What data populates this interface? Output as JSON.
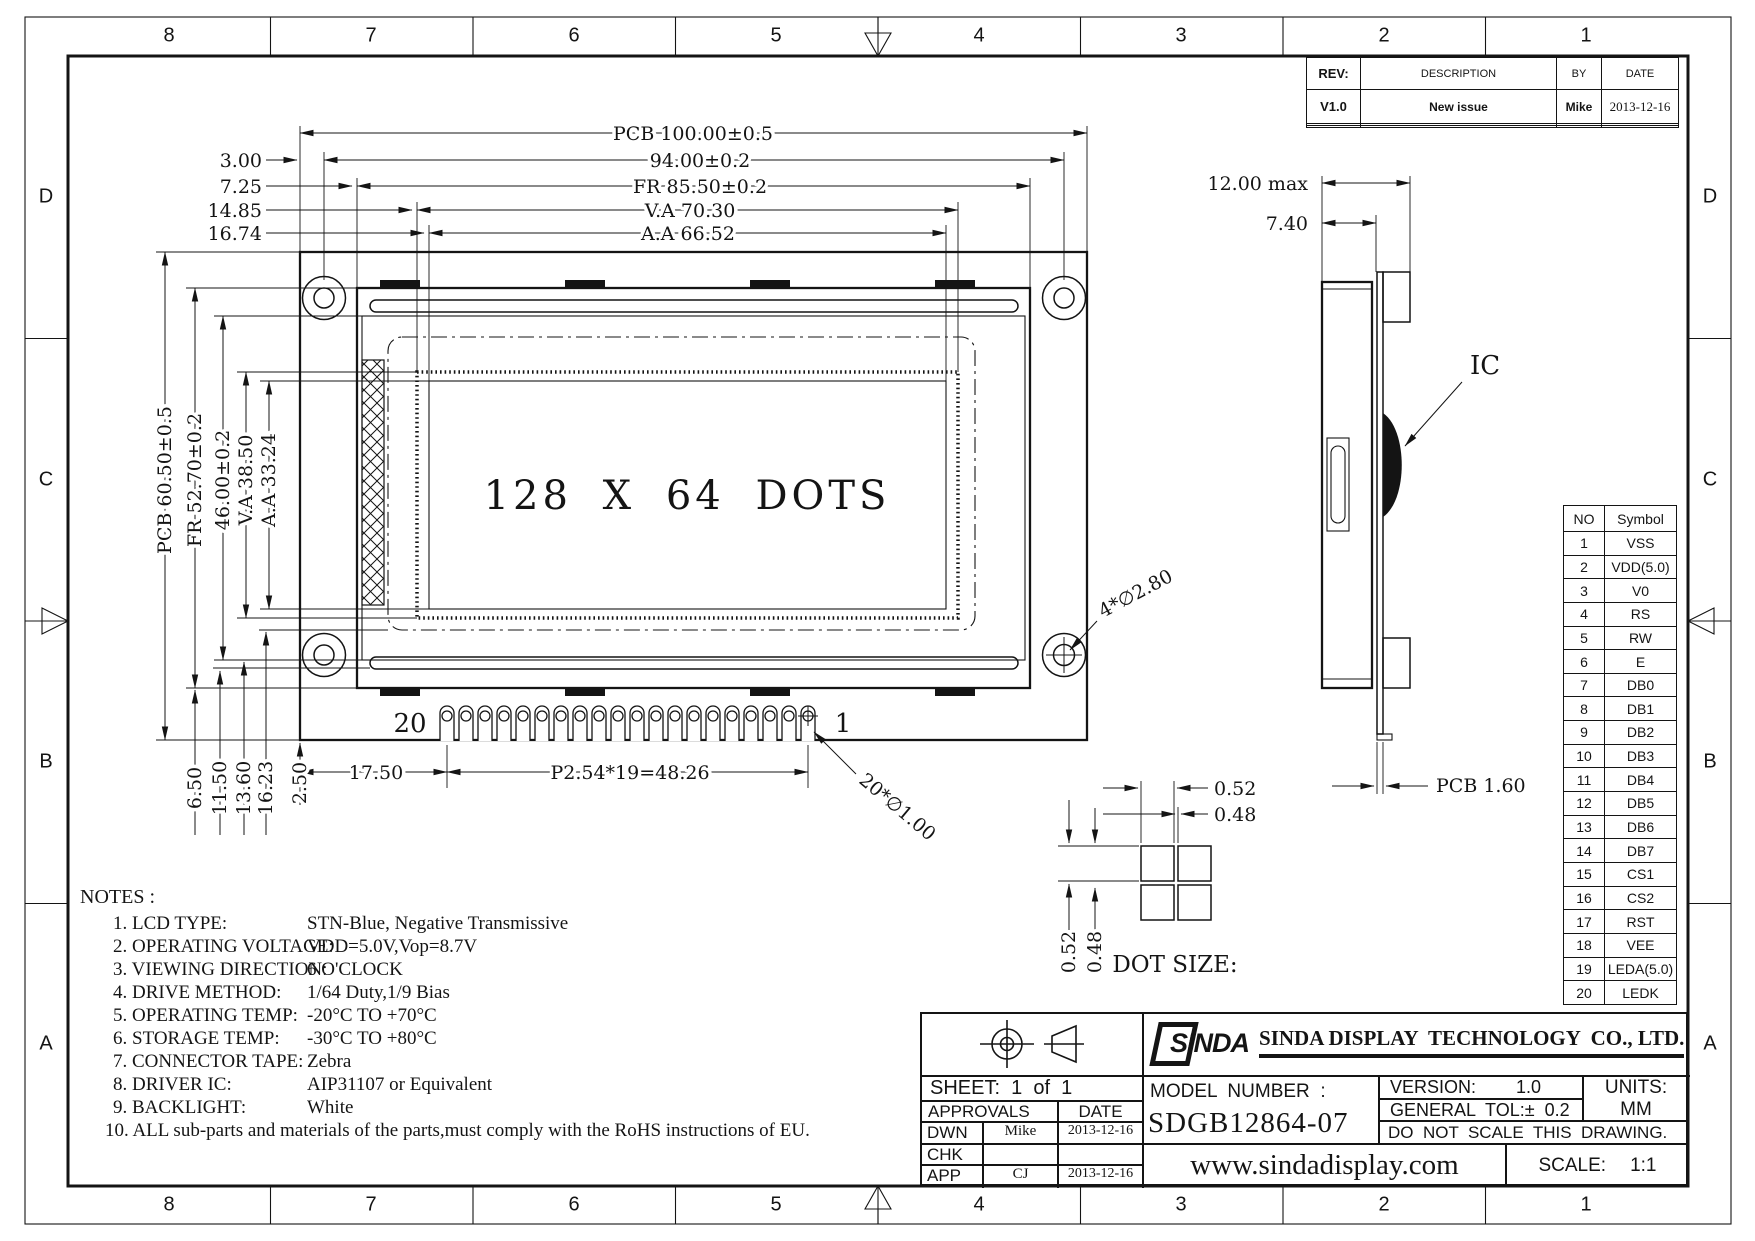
{
  "frame": {
    "cols": [
      "8",
      "7",
      "6",
      "5",
      "4",
      "3",
      "2",
      "1"
    ],
    "rows": [
      "D",
      "C",
      "B",
      "A"
    ]
  },
  "revision_table": {
    "headers": [
      "REV:",
      "DESCRIPTION",
      "BY",
      "DATE"
    ],
    "rows": [
      [
        "V1.0",
        "New issue",
        "Mike",
        "2013-12-16"
      ],
      [
        "",
        "",
        "",
        ""
      ],
      [
        "",
        "",
        "",
        ""
      ]
    ]
  },
  "front_view": {
    "display_text": "128 X 64 DOTS",
    "top_dims": [
      {
        "left": "",
        "label": "PCB 100.00±0.5"
      },
      {
        "left": "3.00",
        "label": "94.00±0.2"
      },
      {
        "left": "7.25",
        "label": "FR 85.50±0.2"
      },
      {
        "left": "14.85",
        "label": "V.A 70.30"
      },
      {
        "left": "16.74",
        "label": "A.A 66.52"
      }
    ],
    "left_dims": [
      "PCB 60.50±0.5",
      "FR 52.70±0.2",
      "46.00±0.2",
      "V.A 38.50",
      "A.A 33.24"
    ],
    "bottom_left_dims": [
      "6.50",
      "11.50",
      "13.60",
      "16.23",
      "2.50"
    ],
    "dim_17_50": "17.50",
    "dim_pitch": "P2.54*19=48.26",
    "pin_last": "20",
    "pin_first": "1",
    "label_pin_hole": "20*∅1.00",
    "label_mount_hole": "4*∅2.80"
  },
  "side_view": {
    "dim_max": "12.00 max",
    "dim_740": "7.40",
    "ic": "IC",
    "pcb": "PCB 1.60"
  },
  "dot_detail": {
    "title": "DOT SIZE:",
    "dim_h": [
      "0.52",
      "0.48"
    ],
    "dim_v": [
      "0.52",
      "0.48"
    ]
  },
  "pin_table": {
    "headers": [
      "NO",
      "Symbol"
    ],
    "rows": [
      [
        "1",
        "VSS"
      ],
      [
        "2",
        "VDD(5.0)"
      ],
      [
        "3",
        "V0"
      ],
      [
        "4",
        "RS"
      ],
      [
        "5",
        "RW"
      ],
      [
        "6",
        "E"
      ],
      [
        "7",
        "DB0"
      ],
      [
        "8",
        "DB1"
      ],
      [
        "9",
        "DB2"
      ],
      [
        "10",
        "DB3"
      ],
      [
        "11",
        "DB4"
      ],
      [
        "12",
        "DB5"
      ],
      [
        "13",
        "DB6"
      ],
      [
        "14",
        "DB7"
      ],
      [
        "15",
        "CS1"
      ],
      [
        "16",
        "CS2"
      ],
      [
        "17",
        "RST"
      ],
      [
        "18",
        "VEE"
      ],
      [
        "19",
        "LEDA(5.0)"
      ],
      [
        "20",
        "LEDK"
      ]
    ]
  },
  "notes": {
    "title": "NOTES :",
    "items": [
      {
        "label": "1. LCD TYPE:",
        "value": "STN-Blue, Negative Transmissive"
      },
      {
        "label": "2. OPERATING VOLTAGE:",
        "value": "VDD=5.0V,Vop=8.7V"
      },
      {
        "label": "3. VIEWING DIRECTION:",
        "value": "6 O'CLOCK"
      },
      {
        "label": "4. DRIVE METHOD:",
        "value": "1/64 Duty,1/9 Bias"
      },
      {
        "label": "5. OPERATING TEMP:",
        "value": "-20°C TO +70°C"
      },
      {
        "label": "6. STORAGE TEMP:",
        "value": "-30°C TO +80°C"
      },
      {
        "label": "7. CONNECTOR TAPE:",
        "value": "Zebra"
      },
      {
        "label": "8. DRIVER IC:",
        "value": "AIP31107 or Equivalent"
      },
      {
        "label": "9. BACKLIGHT:",
        "value": "White"
      },
      {
        "label": "10. ALL sub-parts and materials of the parts,must comply with the RoHS instructions of EU.",
        "value": ""
      }
    ]
  },
  "title_block": {
    "sheet": "SHEET:  1  of  1",
    "approvals": "APPROVALS",
    "date_hdr": "DATE",
    "sign_rows": [
      [
        "DWN",
        "Mike",
        "2013-12-16"
      ],
      [
        "CHK",
        "",
        ""
      ],
      [
        "APP",
        "CJ",
        "2013-12-16"
      ]
    ],
    "logo": "SINDA",
    "company": "SINDA DISPLAY  TECHNOLOGY  CO., LTD.",
    "model_label": "MODEL  NUMBER  :",
    "model": "SDGB12864-07",
    "version_label": "VERSION:",
    "version": "1.0",
    "tol": "GENERAL  TOL:±  0.2",
    "no_scale": "DO  NOT  SCALE  THIS  DRAWING.",
    "units_label": "UNITS:",
    "units": "MM",
    "website": "www.sindadisplay.com",
    "scale_label": "SCALE:",
    "scale": "1:1"
  }
}
